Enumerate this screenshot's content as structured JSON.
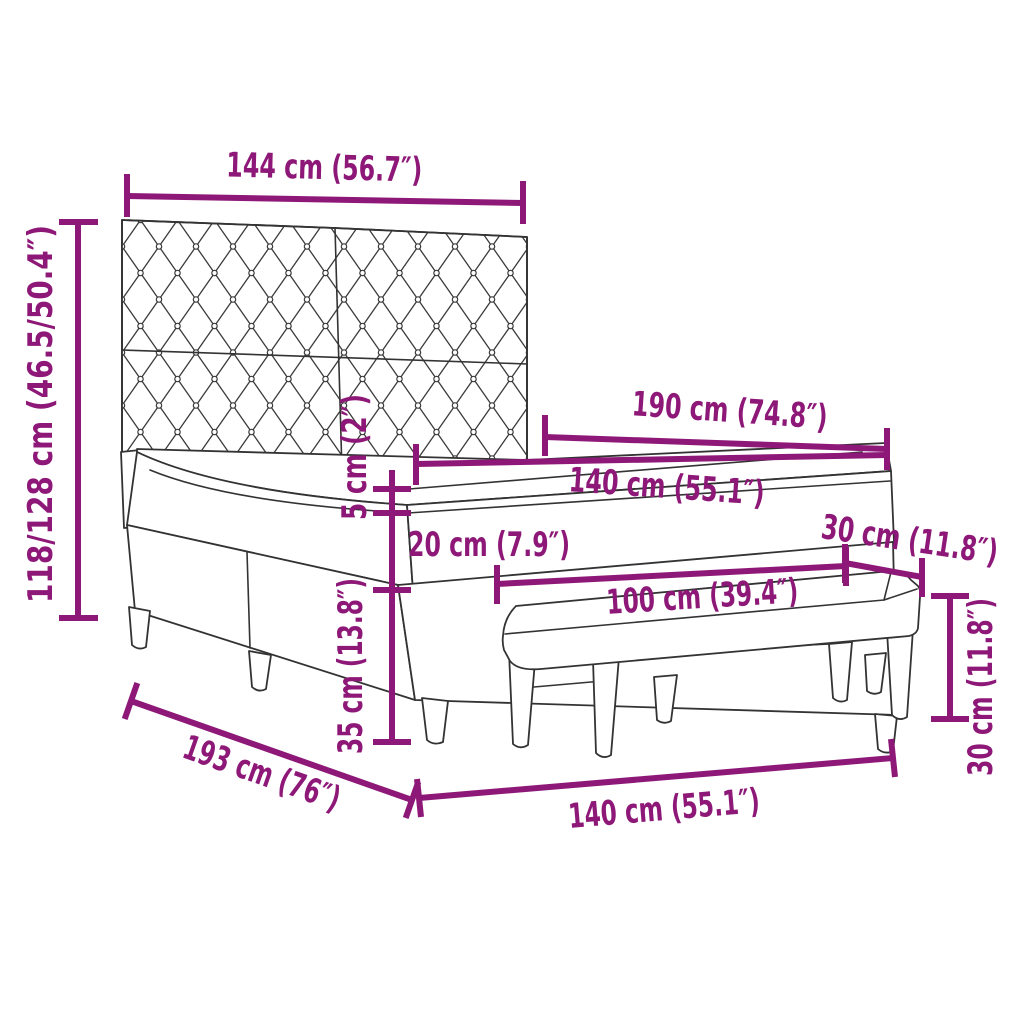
{
  "theme": {
    "accent_color": "#8E1878",
    "line_color": "#333333",
    "background_color": "#FFFFFF"
  },
  "diagram": {
    "type": "furniture-dimension-diagram",
    "subject": "box spring bed with tufted headboard, mattress, topper and bench",
    "units": [
      "cm",
      "inch"
    ]
  },
  "dims": {
    "headboard_width": {
      "label": "144 cm (56.7″)"
    },
    "total_height": {
      "label": "118/128 cm (46.5/50.4″)"
    },
    "bed_length": {
      "label": "190 cm (74.8″)"
    },
    "mattress_width": {
      "label": "140 cm (55.1″)"
    },
    "topper_height": {
      "label": "5 cm (2″)"
    },
    "mattress_height": {
      "label": "20 cm (7.9″)"
    },
    "bench_depth": {
      "label": "30 cm (11.8″)"
    },
    "bench_width": {
      "label": "100 cm (39.4″)"
    },
    "base_height": {
      "label": "35 cm (13.8″)"
    },
    "bench_height": {
      "label": "30 cm (11.8″)"
    },
    "frame_length": {
      "label": "193 cm (76″)"
    },
    "frame_width": {
      "label": "140 cm (55.1″)"
    }
  }
}
